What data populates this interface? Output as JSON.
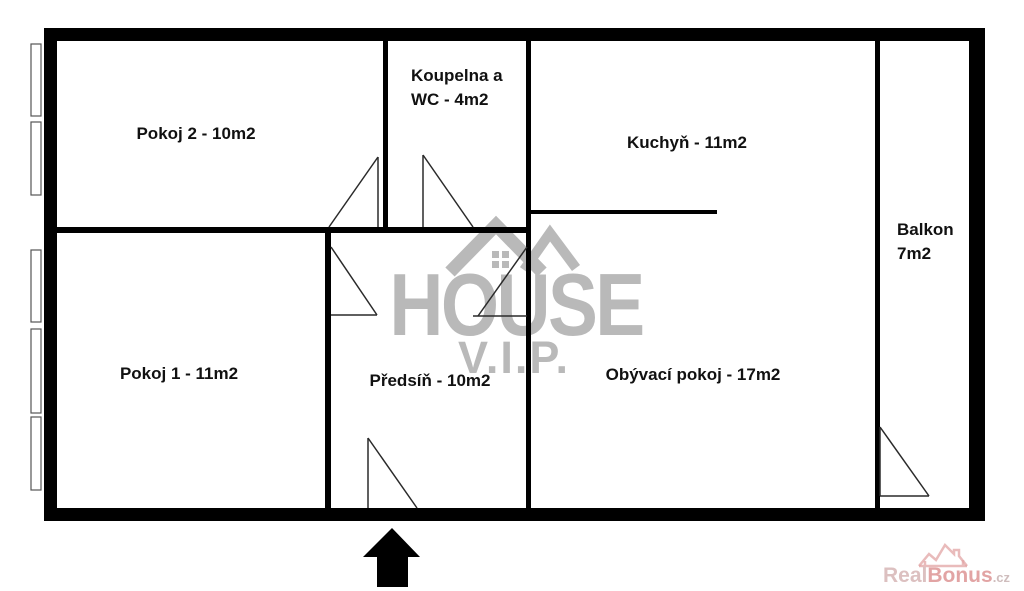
{
  "watermark": {
    "brand": "HOUSE",
    "sub": "V.I.P."
  },
  "rooms": {
    "pokoj2": {
      "label": "Pokoj 2 - 10m2"
    },
    "koupelna": {
      "line1": "Koupelna a",
      "line2": "WC - 4m2"
    },
    "kuchyn": {
      "label": "Kuchyň - 11m2"
    },
    "balkon": {
      "line1": "Balkon",
      "line2": "7m2"
    },
    "pokoj1": {
      "label": "Pokoj 1 - 11m2"
    },
    "predsin": {
      "label": "Předsíň - 10m2"
    },
    "obyvaci": {
      "label": "Obývací pokoj - 17m2"
    }
  },
  "footer": {
    "brand_part1": "Real",
    "brand_part2": "Bonus",
    "brand_tld": ".cz"
  },
  "colors": {
    "wall": "#000000",
    "door_line": "#2a2a2a",
    "window_border": "#555555",
    "watermark_gray": "#b9b9b9",
    "brand_pink": "#e2a4a4",
    "brand_light_pink": "#dcc0c0",
    "brand_tld": "#cfbdbd",
    "label_color": "#111111"
  }
}
